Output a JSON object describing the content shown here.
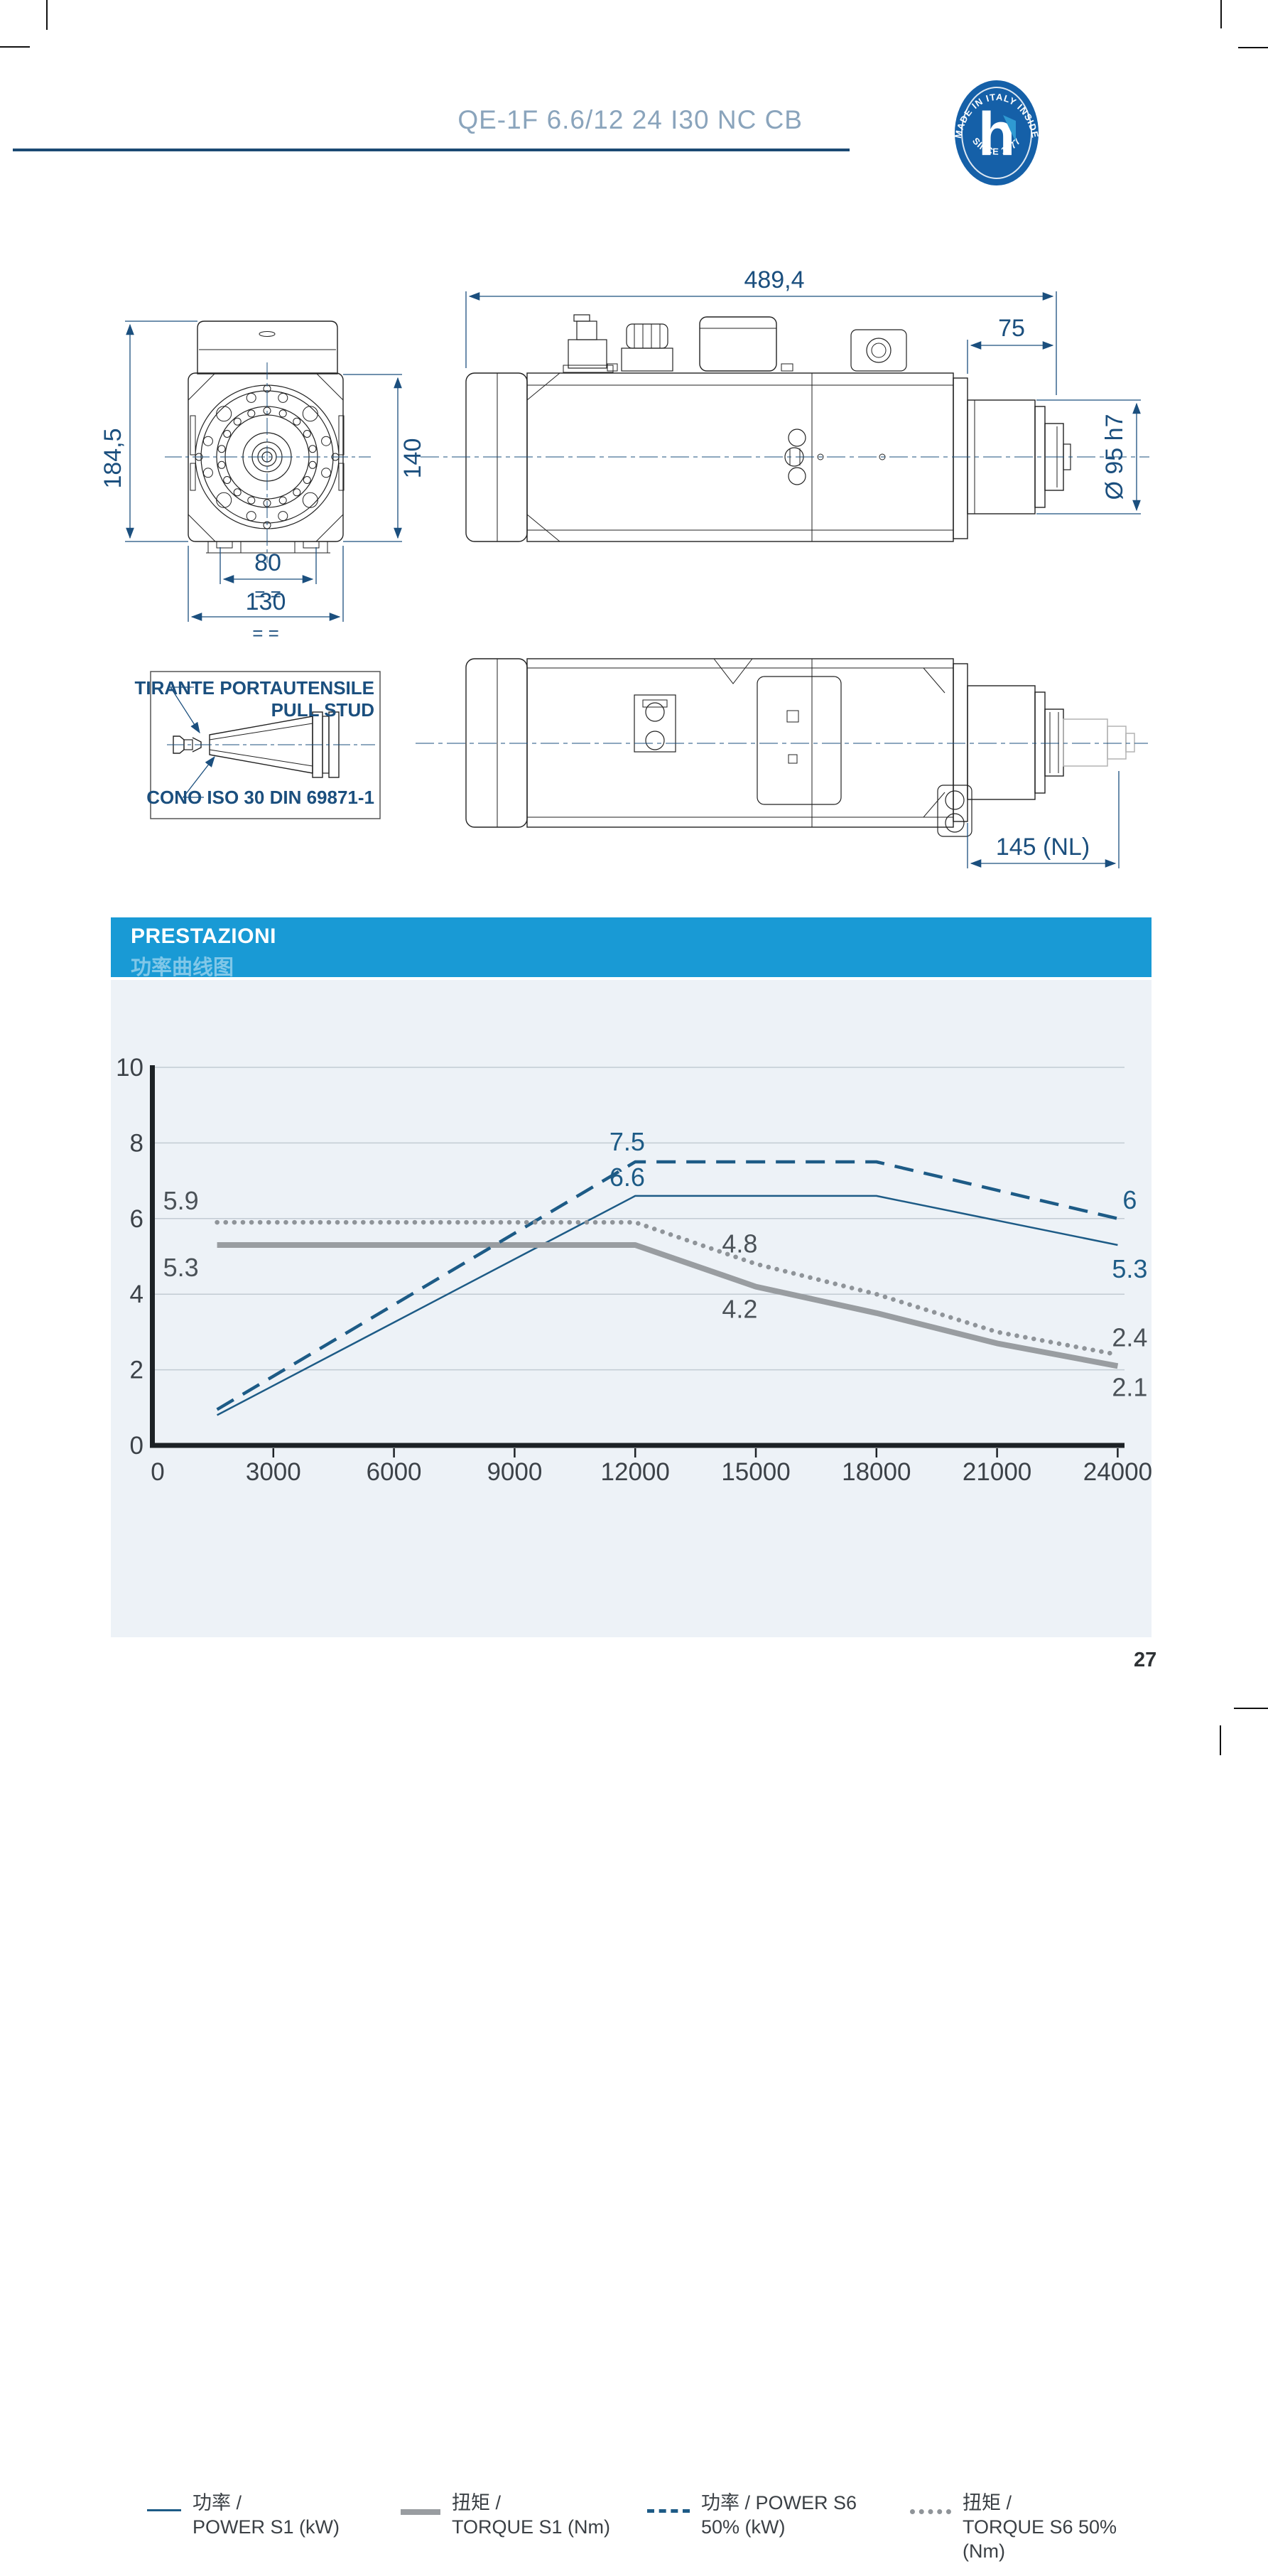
{
  "header": {
    "model": "QE-1F 6.6/12 24 I30 NC CB",
    "badge": {
      "top_text": "MADE IN ITALY INSIDE",
      "bottom_text": "SINCE 1977",
      "letter": "h"
    }
  },
  "colors": {
    "band_blue": "#199ad5",
    "dim_navy": "#1b4f7e",
    "title_blue": "#8aa4bc",
    "badge_blue": "#1560a8",
    "badge_accent": "#2f9ad2",
    "power_line": "#1d5b86",
    "torque_line": "#999da1",
    "gray_label": "#4b5258",
    "panel_bg": "#edf2f7"
  },
  "drawings": {
    "front_view": {
      "dims": {
        "height": "184,5",
        "flange": "140",
        "hole_spacing": "80",
        "width": "130",
        "equals": "= ="
      }
    },
    "side_view": {
      "dims": {
        "length": "489,4",
        "nose_length": "75",
        "nose_diameter": "Ø 95 h7"
      }
    },
    "bottom_view": {
      "dims": {
        "nose_total": "145 (NL)"
      }
    },
    "tool_detail": {
      "pull_stud_it": "TIRANTE PORTAUTENSILE",
      "pull_stud_en": "PULL STUD",
      "cone": "CONO ISO 30 DIN 69871-1"
    }
  },
  "performance": {
    "title": "PRESTAZIONI",
    "subtitle": "功率曲线图",
    "chart_data": {
      "type": "line",
      "xlabel": "spindle speed (rpm)",
      "ylabel": "",
      "xlim": [
        0,
        24000
      ],
      "ylim": [
        0,
        10
      ],
      "x_ticks": [
        0,
        3000,
        6000,
        9000,
        12000,
        15000,
        18000,
        21000,
        24000
      ],
      "y_ticks": [
        0,
        2,
        4,
        6,
        8,
        10
      ],
      "grid": true,
      "legend_position": "bottom",
      "series": [
        {
          "name": "POWER S1 (kW)",
          "style": "solid-blue",
          "points": [
            [
              1600,
              0.8
            ],
            [
              12000,
              6.6
            ],
            [
              18000,
              6.6
            ],
            [
              24000,
              5.3
            ]
          ]
        },
        {
          "name": "TORQUE S1 (Nm)",
          "style": "thick-gray",
          "points": [
            [
              1600,
              5.3
            ],
            [
              12000,
              5.3
            ],
            [
              15000,
              4.2
            ],
            [
              18000,
              3.5
            ],
            [
              21000,
              2.7
            ],
            [
              24000,
              2.1
            ]
          ]
        },
        {
          "name": "POWER S6 50% (kW)",
          "style": "dashed-blue",
          "points": [
            [
              1600,
              0.95
            ],
            [
              12000,
              7.5
            ],
            [
              18000,
              7.5
            ],
            [
              24000,
              6.0
            ]
          ]
        },
        {
          "name": "TORQUE S6 50% (Nm)",
          "style": "dotted-gray",
          "points": [
            [
              1600,
              5.9
            ],
            [
              12000,
              5.9
            ],
            [
              15000,
              4.8
            ],
            [
              18000,
              4.0
            ],
            [
              21000,
              3.0
            ],
            [
              24000,
              2.4
            ]
          ]
        }
      ],
      "point_labels": [
        {
          "text": "7.5",
          "x": 11800,
          "y": 7.5,
          "dy": -16,
          "color": "power"
        },
        {
          "text": "6.6",
          "x": 11800,
          "y": 6.6,
          "dy": -14,
          "color": "power"
        },
        {
          "text": "5.9",
          "x": 700,
          "y": 5.9,
          "dy": -18,
          "color": "gray"
        },
        {
          "text": "5.3",
          "x": 700,
          "y": 5.3,
          "dy": 44,
          "color": "gray"
        },
        {
          "text": "4.8",
          "x": 14600,
          "y": 4.8,
          "dy": -16,
          "color": "gray"
        },
        {
          "text": "4.2",
          "x": 14600,
          "y": 4.2,
          "dy": 44,
          "color": "gray"
        },
        {
          "text": "6",
          "x": 24300,
          "y": 6.0,
          "dy": -14,
          "color": "power"
        },
        {
          "text": "5.3",
          "x": 24300,
          "y": 5.3,
          "dy": 46,
          "color": "power"
        },
        {
          "text": "2.4",
          "x": 24300,
          "y": 2.4,
          "dy": -12,
          "color": "gray"
        },
        {
          "text": "2.1",
          "x": 24300,
          "y": 2.1,
          "dy": 42,
          "color": "gray"
        }
      ]
    },
    "legend": [
      {
        "line1": "功率 /",
        "line2": "POWER S1 (kW)",
        "style": "solid-blue",
        "left": 51
      },
      {
        "line1": "扭矩 /",
        "line2": "TORQUE S1 (Nm)",
        "style": "thick-gray",
        "left": 408
      },
      {
        "line1": "功率 / POWER S6",
        "line2": "50% (kW)",
        "style": "dashed-blue",
        "left": 755
      },
      {
        "line1": "扭矩 /",
        "line2": "TORQUE S6 50% (Nm)",
        "style": "dotted-gray",
        "left": 1125
      }
    ]
  },
  "footer": {
    "page_number": "27"
  }
}
